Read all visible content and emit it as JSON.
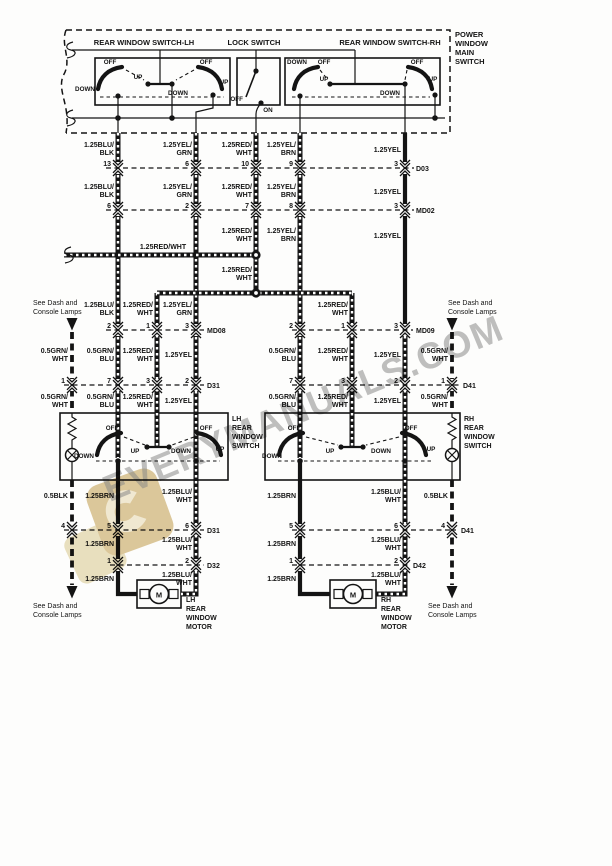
{
  "watermark": {
    "text": "EVERYMANUALS.COM",
    "logo_color": "#d9c28f",
    "logo_color2": "#e8ddb9"
  },
  "page": {
    "title_block": [
      "POWER",
      "WINDOW",
      "MAIN",
      "SWITCH"
    ],
    "see_dash": [
      "See Dash and",
      "Console Lamps"
    ]
  },
  "main_switch": {
    "lh_label": "REAR WINDOW SWITCH-LH",
    "lock_label": "LOCK SWITCH",
    "rh_label": "REAR WINDOW SWITCH-RH"
  },
  "sw": {
    "off": "OFF",
    "on": "ON",
    "up": "UP",
    "down": "DOWN"
  },
  "wire": {
    "blu_blk": [
      "1.25BLU/",
      "BLK"
    ],
    "yel_grn": [
      "1.25YEL/",
      "GRN"
    ],
    "red_wht": [
      "1.25RED/",
      "WHT"
    ],
    "yel_brn": [
      "1.25YEL/",
      "BRN"
    ],
    "yel": "1.25YEL",
    "red_wht_1l": "1.25RED/WHT",
    "grn_wht": [
      "0.5GRN/",
      "WHT"
    ],
    "grn_blu": [
      "0.5GRN/",
      "BLU"
    ],
    "blk": "0.5BLK",
    "brn": "1.25BRN",
    "blu_wht": [
      "1.25BLU/",
      "WHT"
    ]
  },
  "connectors": {
    "d03": {
      "name": "D03",
      "pins": [
        "13",
        "6",
        "10",
        "9",
        "3"
      ]
    },
    "md02": {
      "name": "MD02",
      "pins": [
        "6",
        "2",
        "7",
        "8",
        "3"
      ]
    },
    "md08": {
      "name": "MD08",
      "pins": [
        "2",
        "1",
        "3"
      ]
    },
    "md09": {
      "name": "MD09",
      "pins": [
        "2",
        "1",
        "3"
      ]
    },
    "d31_top": {
      "name": "D31",
      "pins": [
        "1",
        "7",
        "3",
        "2"
      ]
    },
    "d41_top": {
      "name": "D41",
      "pins": [
        "7",
        "3",
        "2",
        "1"
      ]
    },
    "d31_bot": {
      "name": "D31",
      "pins": [
        "4",
        "5",
        "6"
      ]
    },
    "d41_bot": {
      "name": "D41",
      "pins": [
        "5",
        "6",
        "4"
      ]
    },
    "d32": {
      "name": "D32",
      "pins": [
        "1",
        "2"
      ]
    },
    "d42": {
      "name": "D42",
      "pins": [
        "1",
        "2"
      ]
    }
  },
  "components": {
    "lh_switch": [
      "LH",
      "REAR",
      "WINDOW",
      "SWITCH"
    ],
    "rh_switch": [
      "RH",
      "REAR",
      "WINDOW",
      "SWITCH"
    ],
    "lh_motor": [
      "LH",
      "REAR",
      "WINDOW",
      "MOTOR"
    ],
    "rh_motor": [
      "RH",
      "REAR",
      "WINDOW",
      "MOTOR"
    ],
    "motor_symbol": "M"
  }
}
